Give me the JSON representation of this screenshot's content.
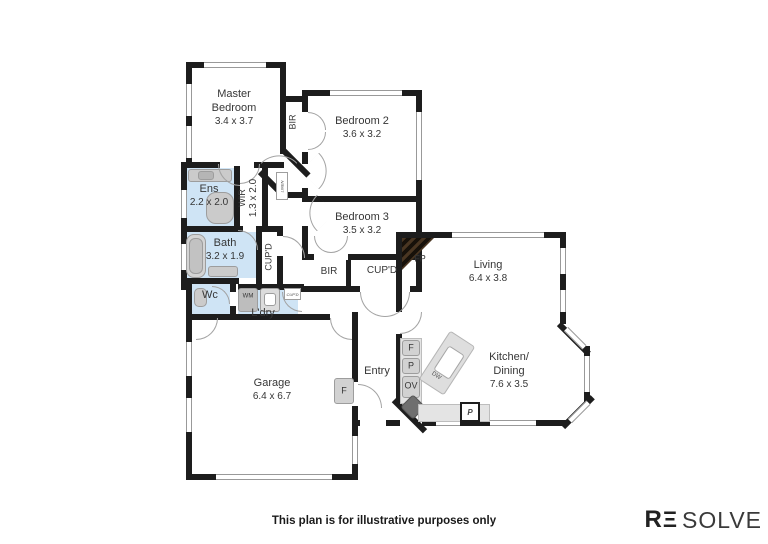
{
  "footer": {
    "disclaimer": "This plan is for illustrative purposes only"
  },
  "logo": {
    "r": "R",
    "e": "Ξ",
    "solve": "SOLVE"
  },
  "rooms": {
    "master": {
      "name": "Master Bedroom",
      "dims": "3.4 x 3.7"
    },
    "bedroom2": {
      "name": "Bedroom 2",
      "dims": "3.6 x 3.2"
    },
    "bedroom3": {
      "name": "Bedroom 3",
      "dims": "3.5 x 3.2"
    },
    "ens": {
      "name": "Ens",
      "dims": "2.2 x 2.0"
    },
    "wir": {
      "name": "WIR",
      "dims": "1.3 x 2.0"
    },
    "bath": {
      "name": "Bath",
      "dims": "3.2 x 1.9"
    },
    "wc": {
      "name": "Wc"
    },
    "laundry": {
      "name": "L'dry"
    },
    "garage": {
      "name": "Garage",
      "dims": "6.4 x 6.7"
    },
    "entry": {
      "name": "Entry"
    },
    "living": {
      "name": "Living",
      "dims": "6.4 x 3.8"
    },
    "kitchen": {
      "name_line1": "Kitchen/",
      "name_line2": "Dining",
      "dims": "7.6 x 3.5"
    }
  },
  "labels": {
    "bir_bed2": "BIR",
    "bir_hall": "BIR",
    "cupd_bath": "CUP'D",
    "cupd_hall": "CUP'D",
    "cupd_laundry": "CUP'D",
    "linen": "LINEN",
    "fireplace": "FP",
    "fridge": "F",
    "pantry": "P",
    "oven": "OV",
    "dishwasher": "DW",
    "washing_machine": "WM",
    "freezer": "F",
    "pantry_bench": "P"
  },
  "colors": {
    "wall": "#1d1d1d",
    "wet_area": "#cfe4f5",
    "fixture": "#cbcbcb",
    "counter": "#e4e4e4",
    "fireplace_wood": "#4a3622"
  }
}
